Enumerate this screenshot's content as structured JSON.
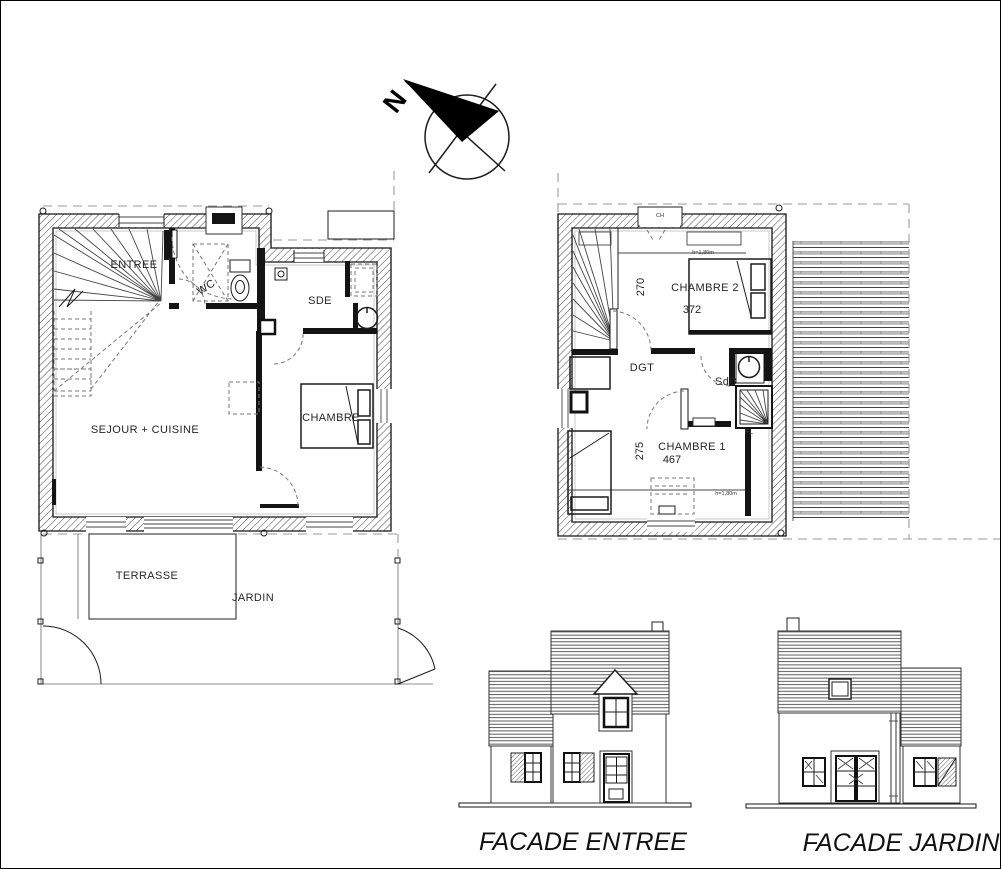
{
  "plan": {
    "compass": {
      "north": "N"
    },
    "ground_floor": {
      "entree": "ENTREE",
      "wc": "WC",
      "sde": "SDE",
      "chambre": "CHAMBRE",
      "sejour": "SEJOUR + CUISINE",
      "terrasse": "TERRASSE",
      "jardin": "JARDIN"
    },
    "first_floor": {
      "chambre2": "CHAMBRE 2",
      "dgt": "DGT",
      "sdb": "SdB",
      "chambre1": "CHAMBRE 1",
      "dim_chambre2_depth": "270",
      "dim_chambre2_width": "372",
      "dim_chambre1_depth": "275",
      "dim_chambre1_width": "467",
      "roof_window": "CH",
      "closet": "PL",
      "height_limit_top": "h=1,80m",
      "height_limit_bottom": "h=1,80m"
    },
    "facades": {
      "entree": "FACADE ENTREE",
      "jardin": "FACADE JARDIN"
    }
  }
}
